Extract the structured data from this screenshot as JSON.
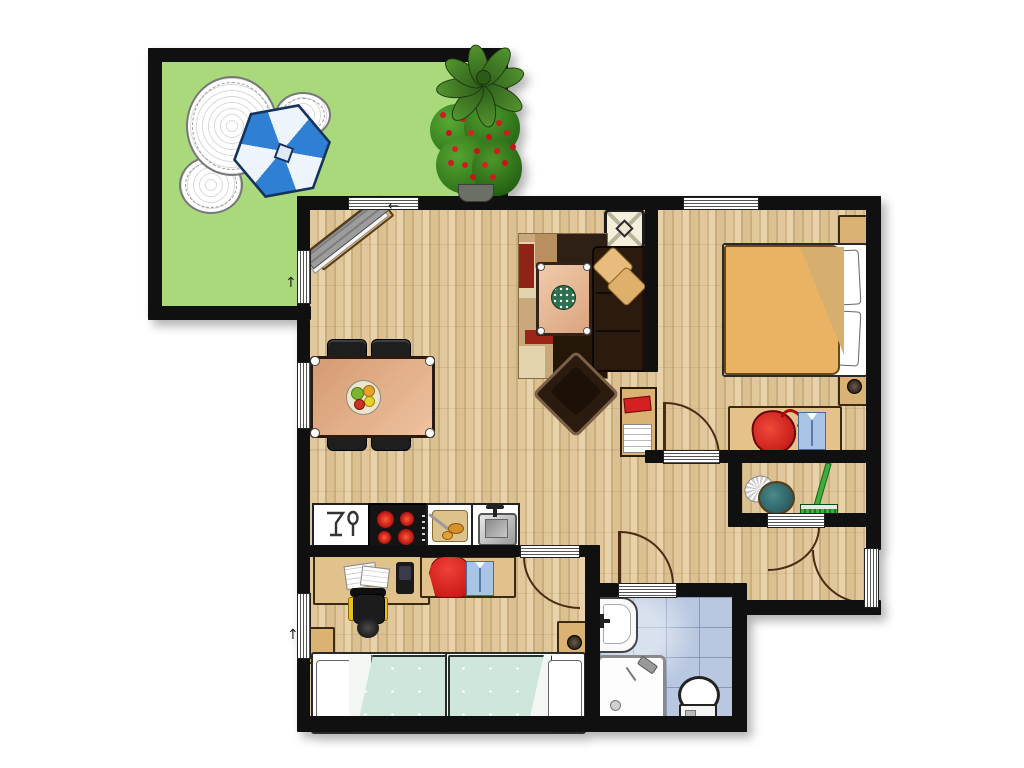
{
  "plan": {
    "title": "apartment-floor-plan-with-garden-terrace",
    "rooms": [
      {
        "id": "garden-terrace",
        "items": [
          "garden-table",
          "garden-chair",
          "garden-chair",
          "parasol",
          "flowering-bush",
          "potted-plant"
        ]
      },
      {
        "id": "living-room",
        "items": [
          "wall-bench",
          "paper-lamp",
          "area-rug",
          "coffee-table",
          "serving-plate",
          "sofa",
          "cushion",
          "cushion",
          "armchair",
          "bookshelf",
          "dining-table",
          "fruit-plate",
          "dining-chair",
          "dining-chair",
          "dining-chair",
          "dining-chair"
        ]
      },
      {
        "id": "kitchen",
        "items": [
          "cabinet-glass-spoon",
          "cooktop",
          "cutting-board",
          "kitchen-sink"
        ]
      },
      {
        "id": "bedroom",
        "items": [
          "double-bed",
          "pillow",
          "pillow",
          "nightstand",
          "nightstand",
          "dresser",
          "red-bag",
          "folded-shirt"
        ]
      },
      {
        "id": "kids-room",
        "items": [
          "desk",
          "papers",
          "telephone",
          "office-chair",
          "clothes-rack",
          "red-sweater",
          "blue-shirt",
          "nightstand",
          "nightstand",
          "single-bed",
          "single-bed"
        ]
      },
      {
        "id": "bathroom",
        "items": [
          "bathroom-sink",
          "shower",
          "toilet"
        ]
      },
      {
        "id": "storage-closet",
        "items": [
          "feather-duster",
          "broom"
        ]
      },
      {
        "id": "hallway",
        "items": []
      }
    ],
    "openings": {
      "windows": [
        "living-top",
        "bedroom-top",
        "garden-side",
        "dining-side",
        "kids-side"
      ],
      "doors": [
        "bedroom-door",
        "kids-room-door",
        "bathroom-door",
        "closet-door",
        "entrance-door"
      ]
    }
  },
  "colors": {
    "wall": "#101010",
    "garden": "#a9d97a",
    "tile": "#b9c8e0",
    "furn-tan": "#d9b274",
    "bed-teal": "#cfe7da",
    "bed-orange": "#eab263",
    "sofa-brown": "#2b1a0e",
    "pillow-tan": "#e7bc7c",
    "table-salmon": "#e3a980",
    "accent-red": "#d42020",
    "umbrella-blue": "#2f7fd4",
    "plant-green": "#3a7a28",
    "shirt-blue": "#a9c4e4",
    "arc-brown": "#4a2c14"
  }
}
